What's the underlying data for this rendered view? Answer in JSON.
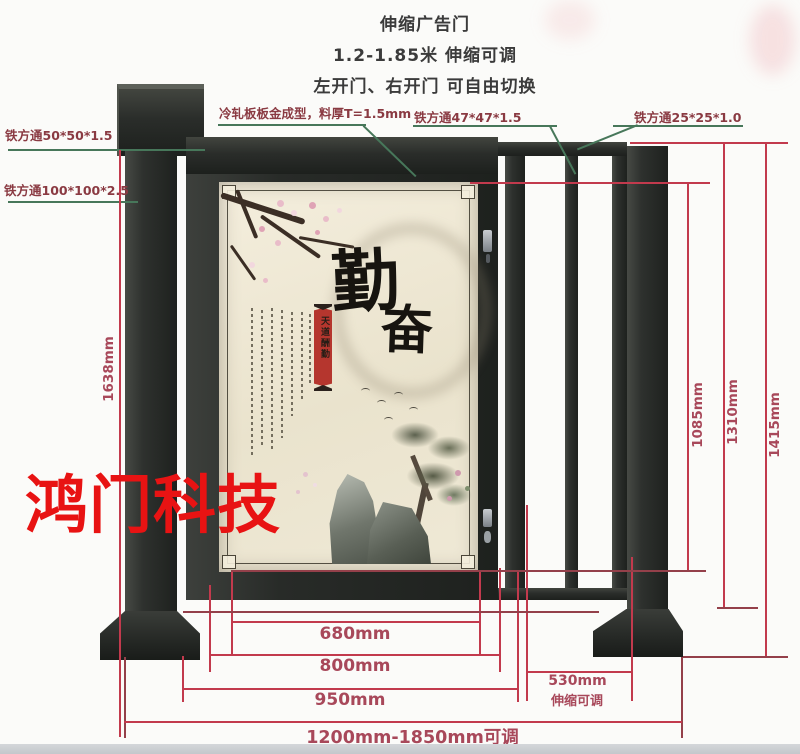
{
  "title": {
    "line1": "伸缩广告门",
    "line2": "1.2-1.85米 伸缩可调",
    "line3": "左开门、右开门 可自由切换"
  },
  "labels": {
    "tube50": "铁方通50*50*1.5",
    "tube100": "铁方通100*100*2.5",
    "coldrolled": "冷轧板板金成型，料厚T=1.5mm",
    "tube47": "铁方通47*47*1.5",
    "tube25": "铁方通25*25*1.0"
  },
  "dims": {
    "d1638": "1638mm",
    "d1085": "1085mm",
    "d1310": "1310mm",
    "d1415": "1415mm",
    "d680": "680mm",
    "d800": "800mm",
    "d950": "950mm",
    "d530": "530mm",
    "d530note": "伸缩可调",
    "range": "1200mm-1850mm可调"
  },
  "watermark": {
    "text": "鸿门科技"
  },
  "poster": {
    "char1": "勤",
    "char2": "奋",
    "seal": "天道酬勤"
  },
  "colors": {
    "dimension_line": "#c23a4d",
    "dimension_line_dark": "#94404a",
    "dimension_text": "#a8485a",
    "part_label_text": "#8a3a42",
    "leader_line_green": "#47775a",
    "metal_dark": "#2b2e2c",
    "poster_background": "#ece5d2",
    "seal_red": "#b5362e",
    "watermark_red": "#e81313"
  }
}
